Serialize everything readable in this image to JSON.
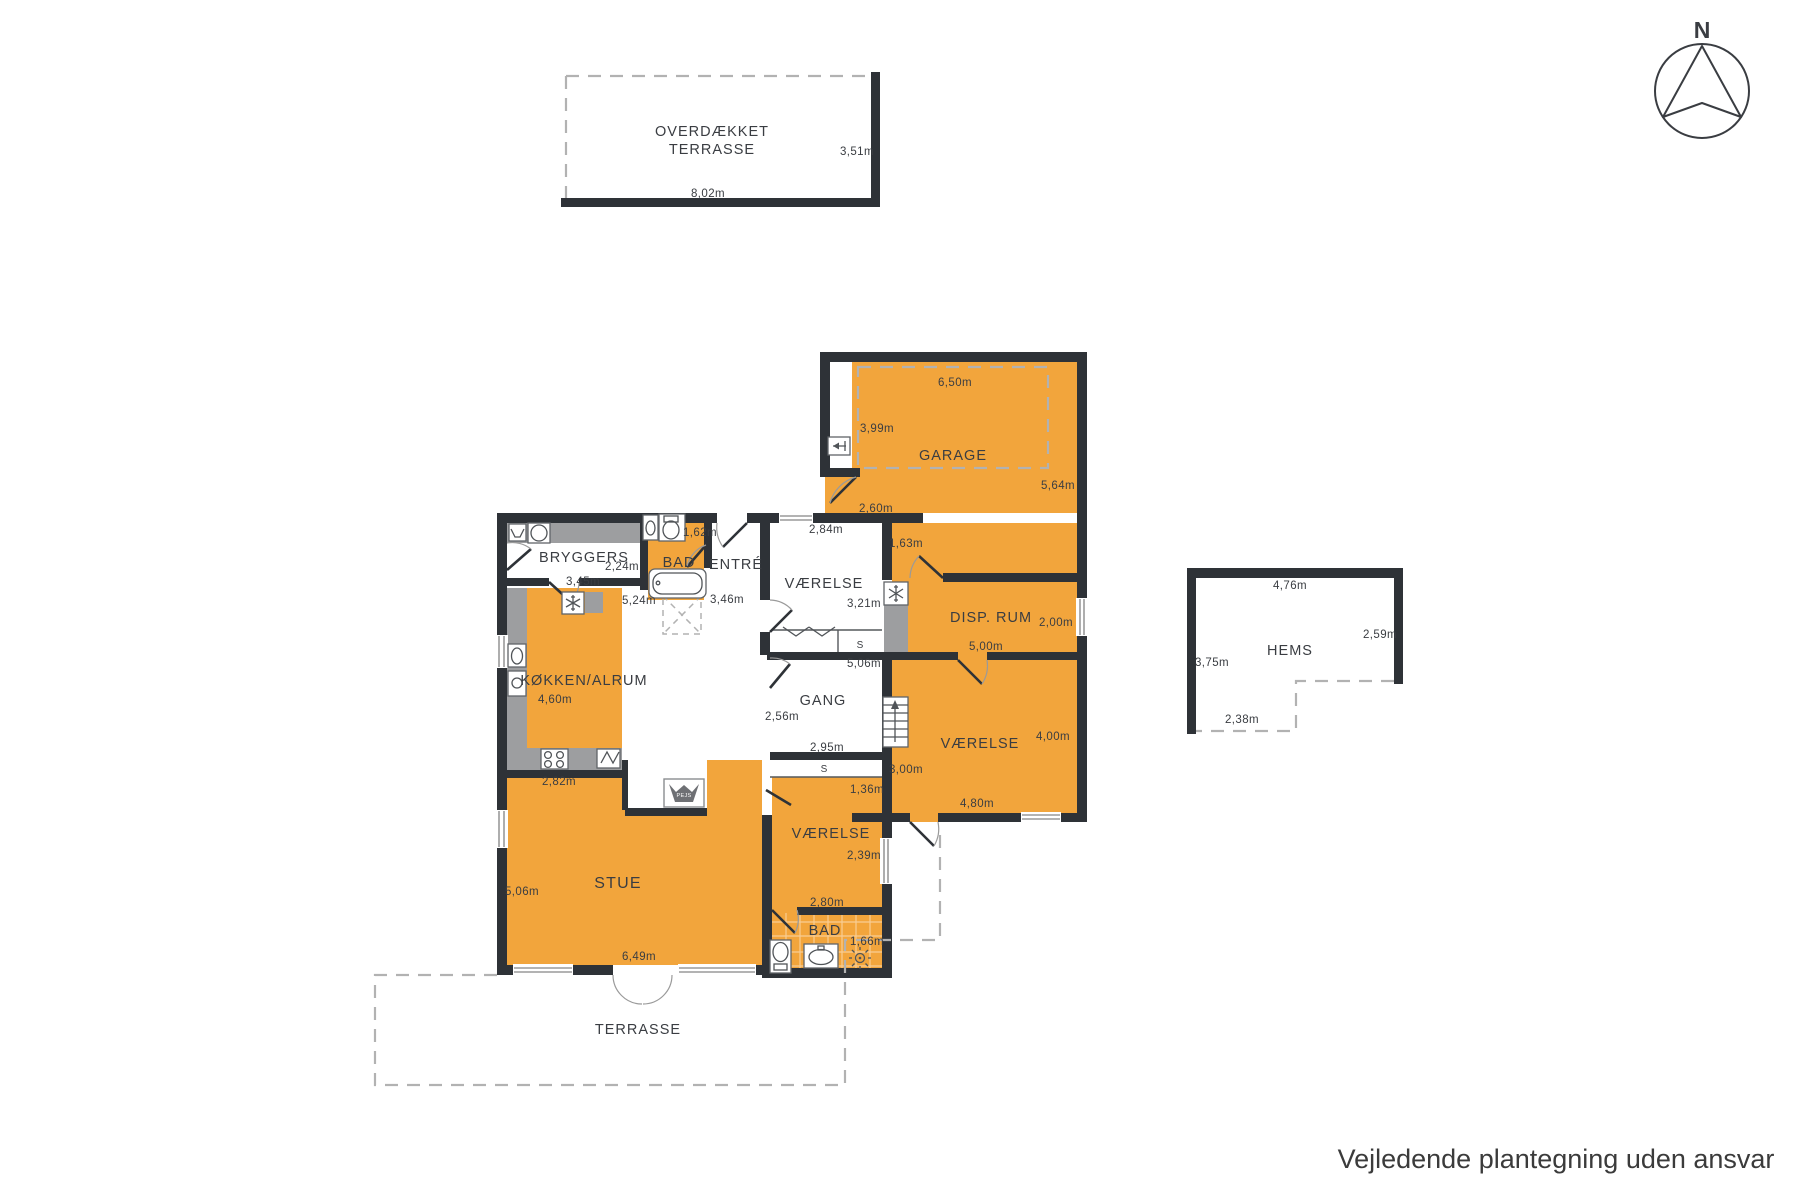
{
  "page": {
    "disclaimer": "Vejledende plantegning uden ansvar"
  },
  "compass": {
    "north": "N"
  },
  "colors": {
    "room_fill": "#F2A53C",
    "wall": "#2E3237",
    "furniture_gray": "#9D9EA0",
    "dash_gray": "#B2B2B2",
    "text": "#3A3D42"
  },
  "covered_terrace": {
    "label_line1": "OVERDÆKKET",
    "label_line2": "TERRASSE",
    "width": "8,02m",
    "depth": "3,51m"
  },
  "garage": {
    "label": "GARAGE",
    "width": "6,50m",
    "depth_left": "3,99m",
    "depth_right": "5,64m",
    "entry_width": "2,60m"
  },
  "hall_niche": {
    "width": "1,63m"
  },
  "bryggers": {
    "label": "BRYGGERS",
    "depth": "2,24m",
    "width": "3,45m"
  },
  "bad_entre": {
    "label": "BAD",
    "width": "1,62m"
  },
  "entre": {
    "label": "ENTRÉ",
    "depth": "3,46m"
  },
  "vaerelse_top": {
    "label": "VÆRELSE",
    "width": "2,84m",
    "depth": "3,21m",
    "closet": "S"
  },
  "disp_rum": {
    "label": "DISP. RUM",
    "width": "5,00m",
    "depth": "2,00m"
  },
  "koekken_alrum": {
    "label": "KØKKEN/ALRUM",
    "depth": "4,60m",
    "length": "5,24m",
    "width_bottom": "2,82m"
  },
  "gang": {
    "label": "GANG",
    "width": "2,56m",
    "length_top": "5,06m",
    "length_bottom": "2,95m",
    "closet": "S"
  },
  "vaerelse_right": {
    "label": "VÆRELSE",
    "width": "4,80m",
    "depth": "4,00m",
    "depth_left": "3,00m",
    "niche": "1,36m"
  },
  "stue": {
    "label": "STUE",
    "width": "6,49m",
    "depth": "5,06m"
  },
  "vaerelse_bottom": {
    "label": "VÆRELSE",
    "width": "2,80m",
    "depth": "2,39m"
  },
  "bad_bottom": {
    "label": "BAD",
    "width": "1,66m"
  },
  "terrasse": {
    "label": "TERRASSE"
  },
  "hems": {
    "label": "HEMS",
    "width_top": "4,76m",
    "depth_right": "2,59m",
    "depth_left": "3,75m",
    "width_bottom": "2,38m"
  },
  "fireplace": {
    "label": "PEJS"
  }
}
